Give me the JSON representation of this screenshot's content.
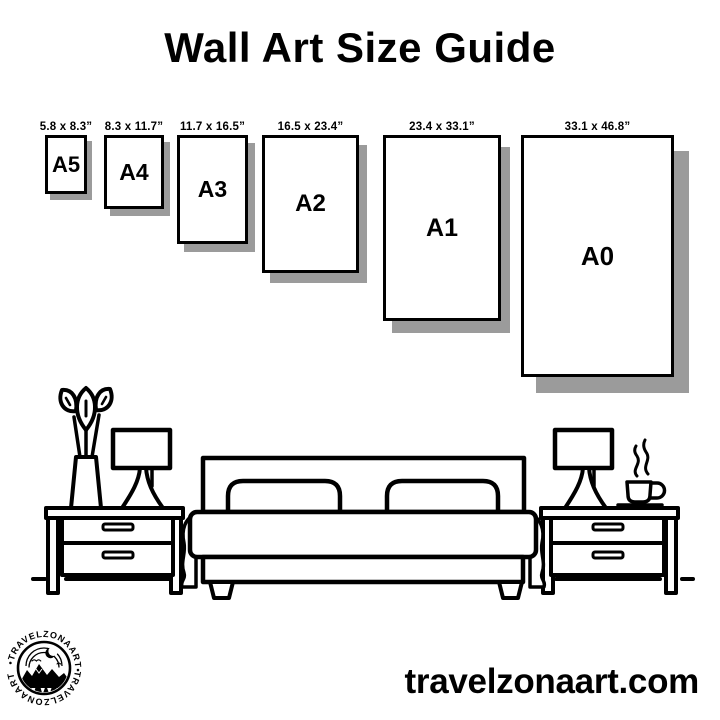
{
  "title": "Wall Art Size Guide",
  "guide": {
    "sizes": [
      {
        "name": "A5",
        "dimensions": "5.8 x 8.3”"
      },
      {
        "name": "A4",
        "dimensions": "8.3 x 11.7”"
      },
      {
        "name": "A3",
        "dimensions": "11.7 x 16.5”"
      },
      {
        "name": "A2",
        "dimensions": "16.5 x 23.4”"
      },
      {
        "name": "A1",
        "dimensions": "23.4 x 33.1”"
      },
      {
        "name": "A0",
        "dimensions": "33.1 x 46.8”"
      }
    ]
  },
  "illustration": {
    "icons": [
      "potted-plant-icon",
      "table-lamp-icon",
      "nightstand-icon",
      "bed-icon",
      "coffee-cup-icon",
      "steam-icon"
    ]
  },
  "branding": {
    "logo_arc_top": "•TRAVELZONAART•",
    "logo_arc_bottom": "TRAVELZONAART",
    "website": "travelzonaart.com"
  },
  "colors": {
    "ink": "#000000",
    "shadow": "#9b9b9b",
    "background": "#ffffff"
  }
}
